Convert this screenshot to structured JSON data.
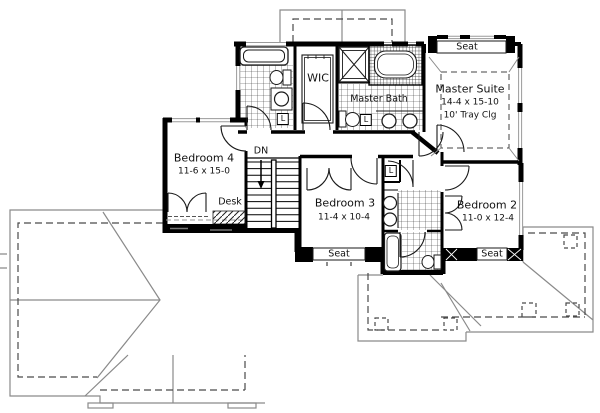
{
  "document": {
    "kind": "floor-plan",
    "level": "second-floor"
  },
  "colors": {
    "wall": "#000000",
    "fixture_line": "#1a1a1a",
    "roof_line": "#8a8a8a",
    "overhang_dashed": "#4a4a4a",
    "window_line": "#9a9a9a",
    "background": "#ffffff"
  },
  "rooms": {
    "master_suite": {
      "name": "Master Suite",
      "dims": "14-4 x 15-10",
      "ceiling": "10' Tray Clg"
    },
    "bedroom4": {
      "name": "Bedroom 4",
      "dims": "11-6 x 15-0"
    },
    "bedroom3": {
      "name": "Bedroom 3",
      "dims": "11-4 x 10-4"
    },
    "bedroom2": {
      "name": "Bedroom 2",
      "dims": "11-0 x 12-4"
    },
    "wic": {
      "name": "WIC"
    },
    "master_bath": {
      "name": "Master Bath"
    }
  },
  "annotations": {
    "stairs_down": "DN",
    "desk": "Desk",
    "seat_master": "Seat",
    "seat_bedroom3": "Seat",
    "seat_bedroom2": "Seat",
    "linen1": "L",
    "linen2": "L",
    "linen3": "L"
  }
}
